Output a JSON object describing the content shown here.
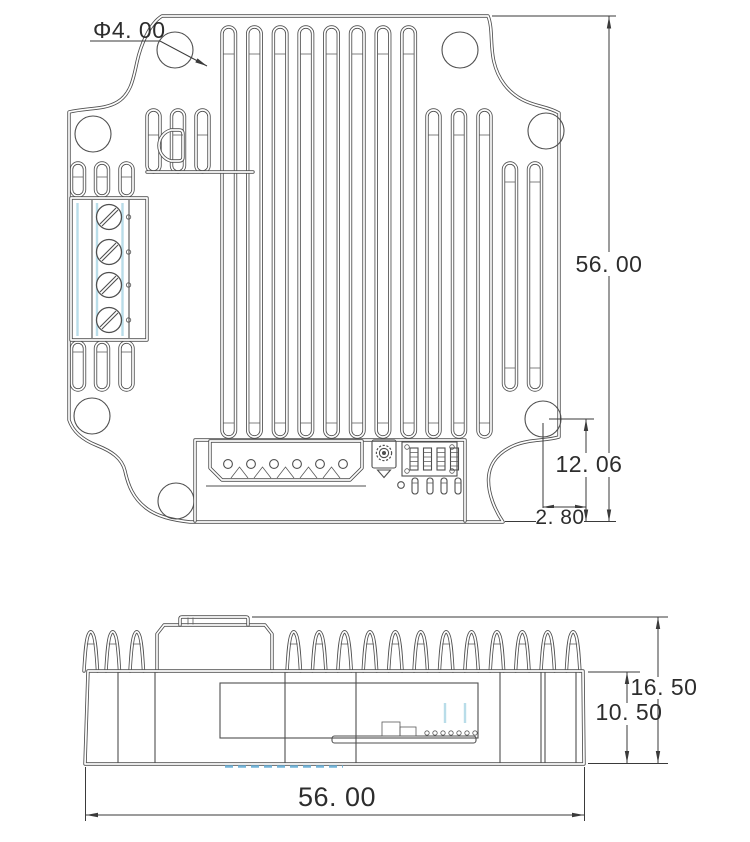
{
  "drawing": {
    "type": "mechanical-drawing",
    "subject": "heatsink driver module - top and side views",
    "dimensions": {
      "hole_diameter": "Φ4. 00",
      "body_height": "56. 00",
      "hole_to_bottom": "12. 06",
      "hole_to_edge": "2. 80",
      "overall_height": "16. 50",
      "base_height": "10. 50",
      "body_width": "56. 00"
    },
    "colors": {
      "line": "#4f4f4f",
      "dimension": "#3a3a3a",
      "text": "#2d2d2d",
      "accent_blue": "#b9dde9",
      "hidden_line_blue": "#72b4d8",
      "background": "#ffffff"
    }
  }
}
